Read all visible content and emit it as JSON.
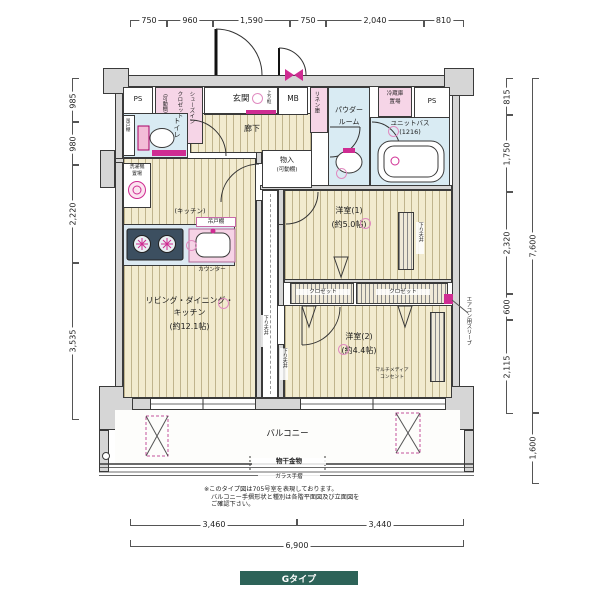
{
  "badge": {
    "label": "Gタイプ",
    "bg": "#2d6358"
  },
  "colors": {
    "wall": "#d6d6d6",
    "floor": "#f2ebcf",
    "wet_area": "#d9ebf3",
    "fixture_pink": "#f6d5e7",
    "accent_magenta": "#cf2c92",
    "line": "#3a3a3a",
    "badge_bg": "#2d6358"
  },
  "dims": {
    "top": [
      "750",
      "960",
      "1,590",
      "750",
      "2,040",
      "810"
    ],
    "left": [
      "985",
      "980",
      "2,220",
      "3,535"
    ],
    "right": [
      "815",
      "1,750",
      "2,320",
      "600",
      "2,115"
    ],
    "right_total": "7,600",
    "balcony_depth": "1,600",
    "bottom": [
      "3,460",
      "3,440"
    ],
    "bottom_total": "6,900"
  },
  "rooms": {
    "entrance": "玄関",
    "corridor": "廊下",
    "toilet": "トイレ",
    "powder_l1": "パウダー",
    "powder_l2": "ルーム",
    "bath_l1": "ユニットバス",
    "bath_l2": "(1216)",
    "ldk_l1": "リビング・ダイニング・",
    "ldk_l2": "キッチン",
    "ldk_size": "(約12.1帖)",
    "kitchen": "(キッチン)",
    "bed1": "洋室(1)",
    "bed1_size": "(約5.0帖)",
    "bed2": "洋室(2)",
    "bed2_size": "(約4.4帖)",
    "balcony": "バルコニー"
  },
  "labels": {
    "ps_left": "PS",
    "ps_right": "PS",
    "mb": "MB",
    "shoes_l1": "シューズイン",
    "shoes_l2": "クロゼット",
    "shoes_l3": "(可動棚)",
    "linen": "リネン庫",
    "fridge_l1": "冷蔵庫",
    "fridge_l2": "置場",
    "washer_l1": "洗濯機",
    "washer_l2": "置場",
    "toilet_shelf": "吊戸棚",
    "storage": "物入",
    "storage_shelf": "(可動棚)",
    "kitchen_shelf": "吊戸棚",
    "counter": "カウンター",
    "agari": "上り框",
    "closet_left": "クロゼット",
    "closet_right": "クロゼット",
    "down_ceiling_a": "下り天井",
    "down_ceiling_b": "下り天井",
    "down_ceiling_c": "下り天井",
    "ac_sleeve": "エアコン用スリーブ",
    "mm_l1": "マルチメディア",
    "mm_l2": "コンセント",
    "laundry": "物干金物",
    "glass_rail": "ガラス手摺"
  },
  "notes": {
    "l1": "※このタイプ図は705号室を表現しております。",
    "l2": "バルコニー手摺形状と種別は各階平面図及び立面図を",
    "l3": "ご確認下さい。"
  }
}
